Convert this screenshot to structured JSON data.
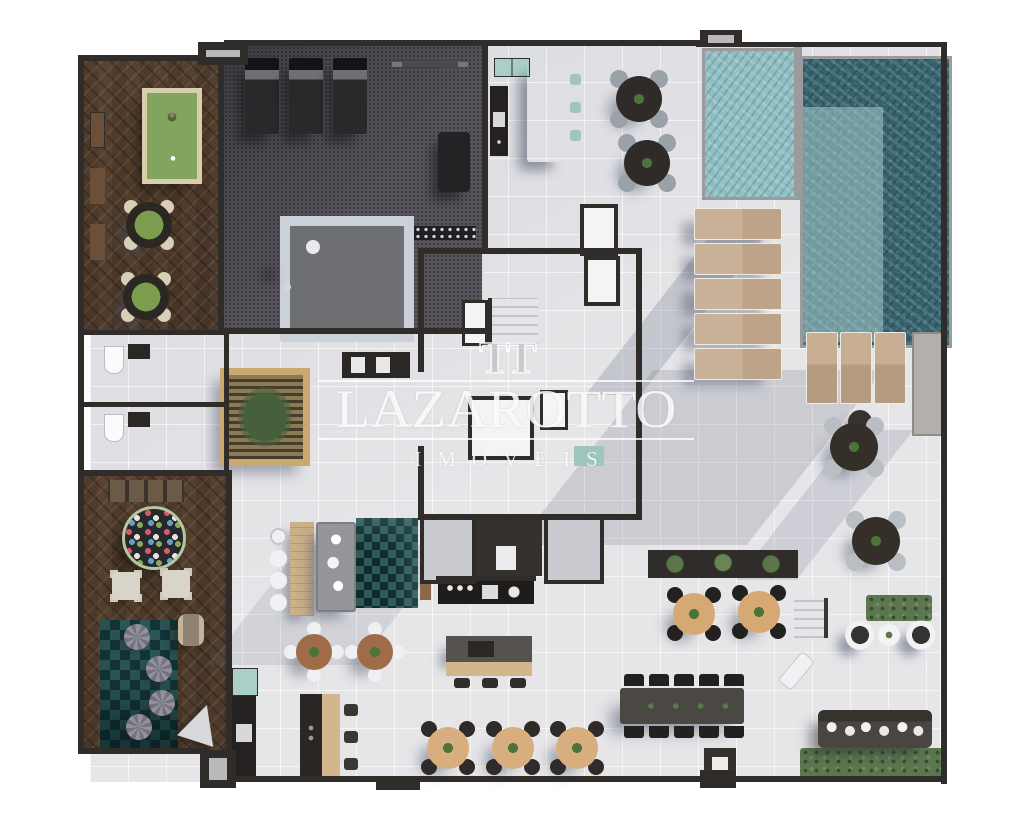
{
  "watermark": {
    "logo": "TT",
    "title": "LAZAROTTO",
    "subtitle": "IMÓVEIS"
  },
  "palette": {
    "wall": "#2f2c29",
    "tile_floor": "#e6e5e8",
    "shadow_blue": "#64708480",
    "wood_floor": "#4e3a2b",
    "gym_carpet": "#56545a",
    "pool_dark": "#34626d",
    "pool_light": "#8fbfc4",
    "lounger_beige": "#c7ae94",
    "billiard_felt": "#83a45e",
    "card_table_felt": "#7c9c4e",
    "table_wood": "#a06b48",
    "table_beige": "#d9ae7e",
    "accent_teal": "#a9cfc7",
    "greenery": "#5c7750",
    "watermark_white": "rgba(255,255,255,0.85)"
  },
  "rooms": [
    "games-room",
    "gym",
    "bar-lounge",
    "pool",
    "sun-deck",
    "stair-core",
    "restrooms",
    "kids-playroom",
    "lounge",
    "gourmet-kitchen",
    "dining-terrace",
    "outdoor-lounge"
  ]
}
